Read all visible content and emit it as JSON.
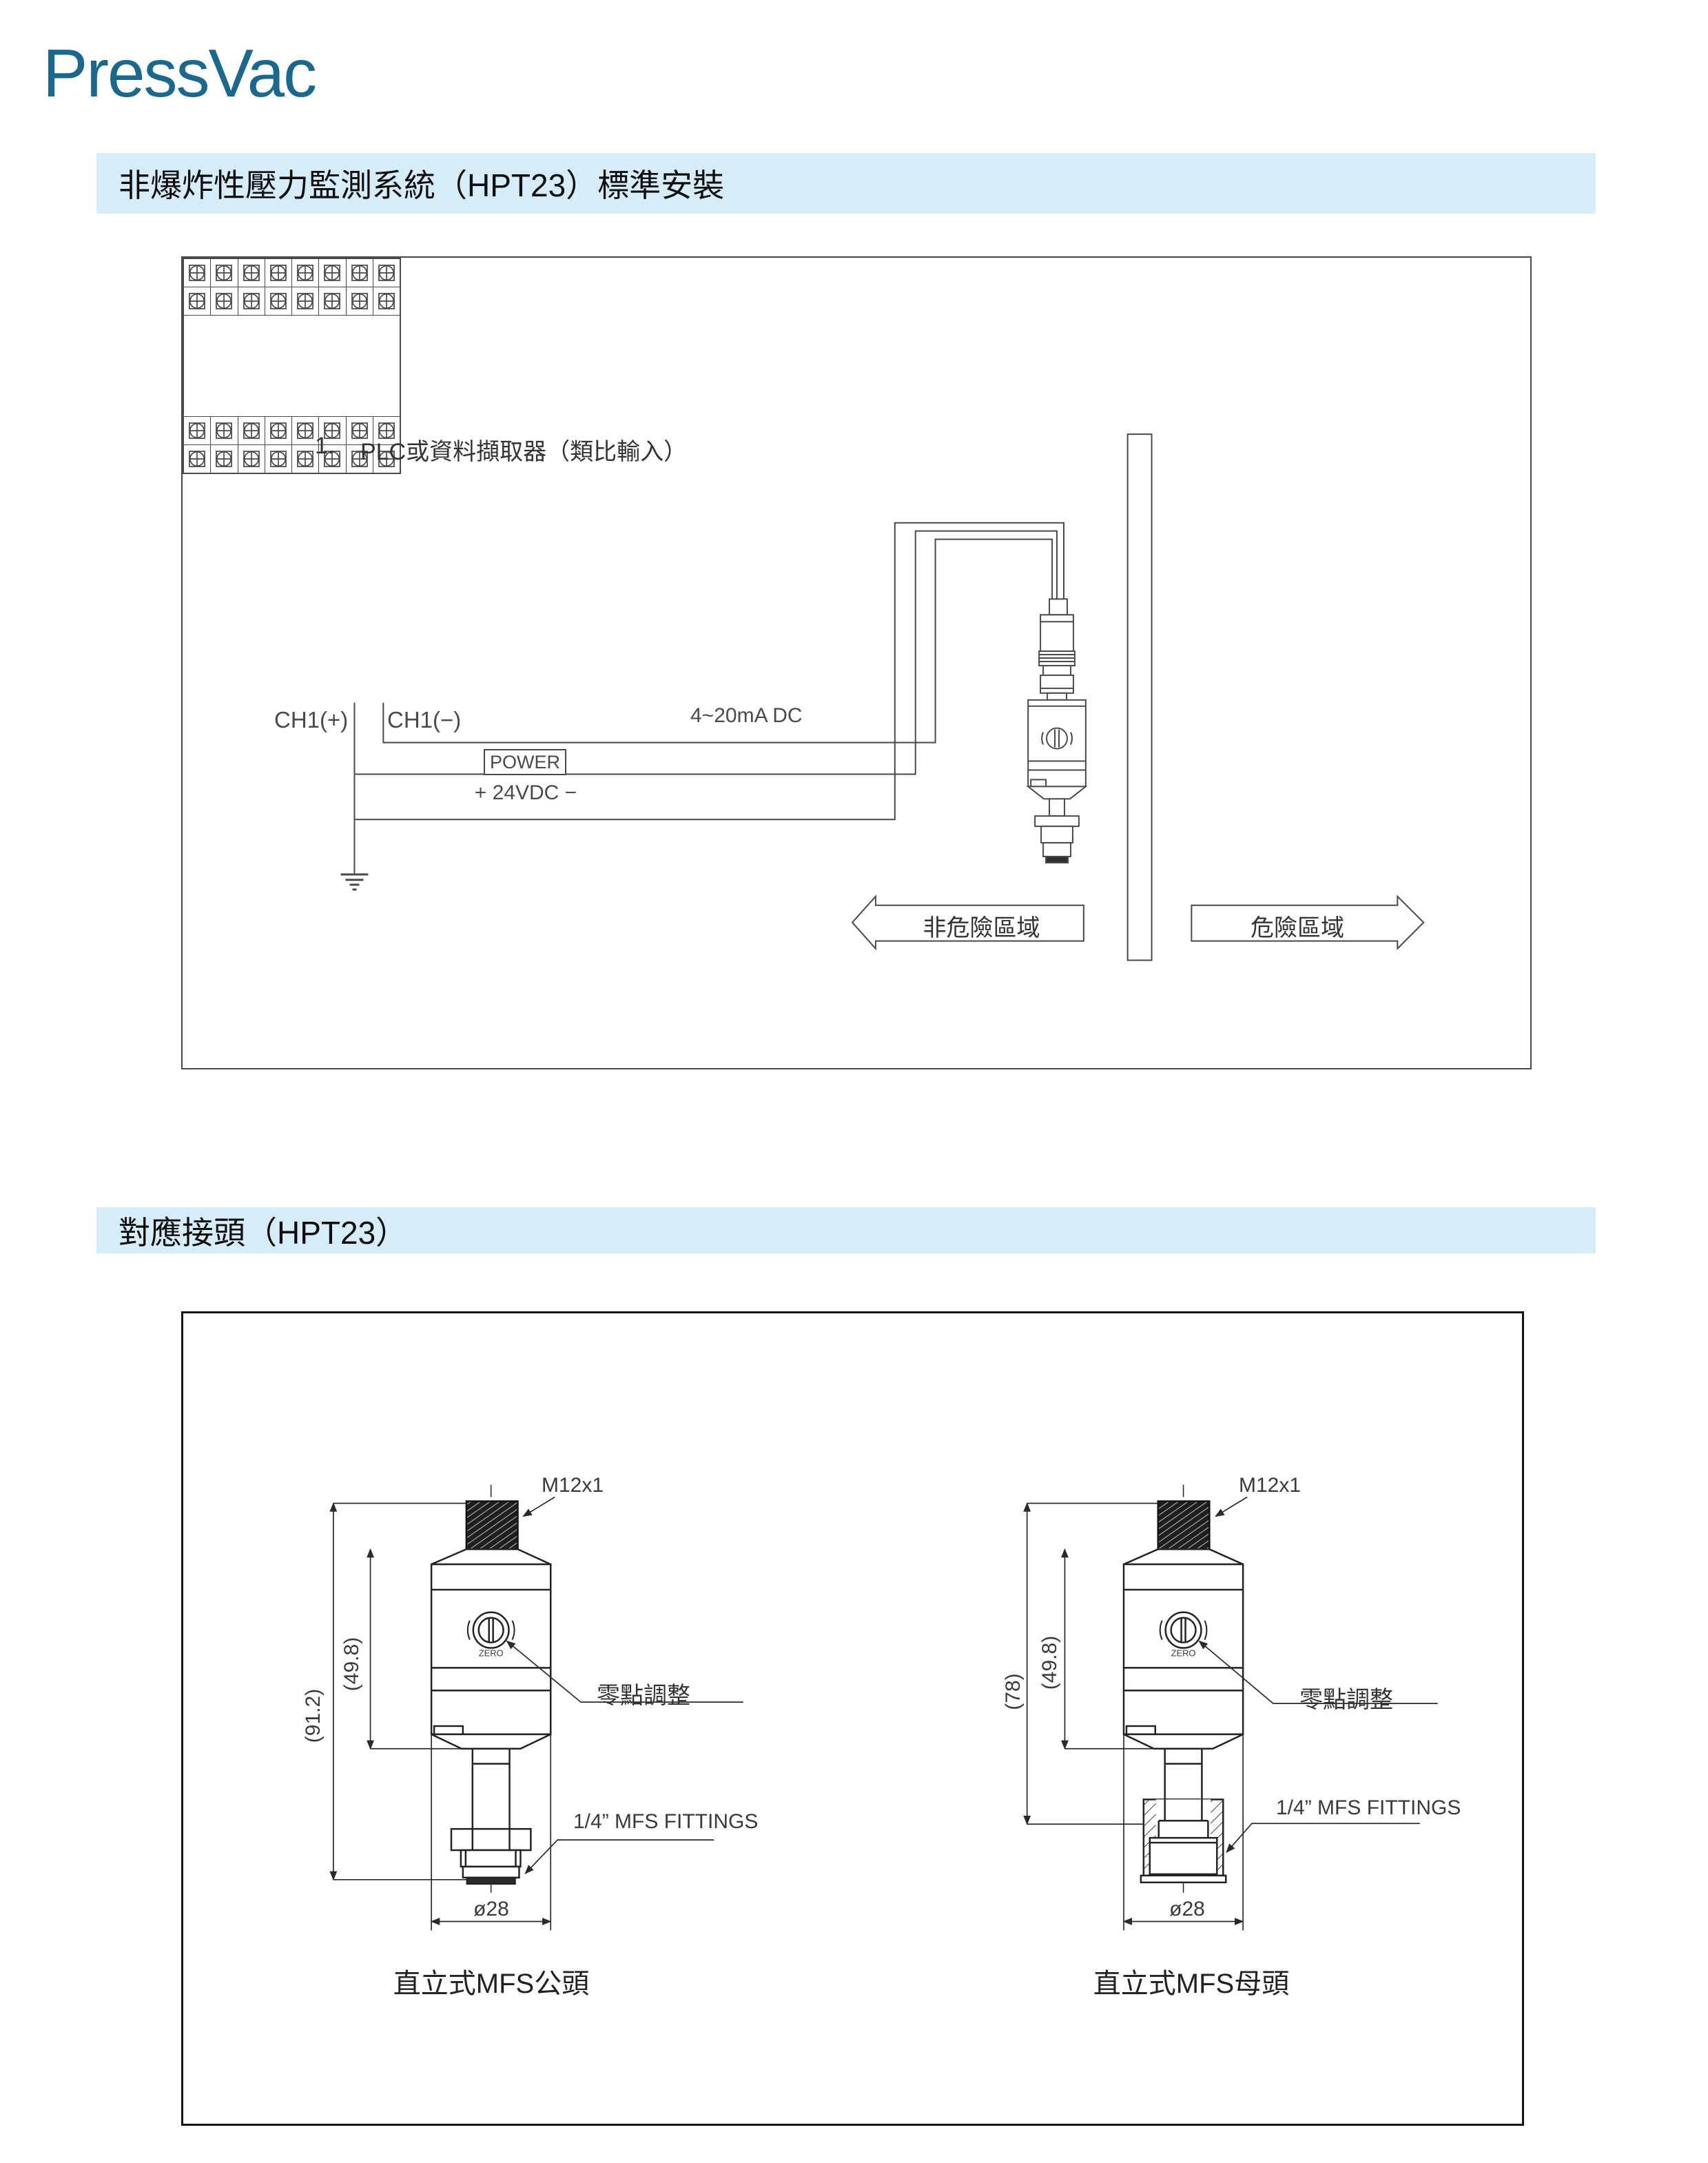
{
  "page": {
    "logo": "PressVac"
  },
  "colors": {
    "accent_band": "#d5edf8",
    "logo": "#19688e",
    "line": "#4a4a4a"
  },
  "section1": {
    "header": "非爆炸性壓力監測系統（HPT23）標準安裝",
    "figure": {
      "plc_item_number": "1.",
      "plc_label": "PLC或資料擷取器（類比輸入）",
      "ch1_plus": "CH1(+)",
      "ch1_minus": "CH1(−)",
      "signal_label": "4~20mA DC",
      "power_label": "POWER",
      "power_voltage": "+ 24VDC −",
      "zone_left": "非危險區域",
      "zone_right": "危險區域",
      "terminal_block": {
        "cols": 8,
        "top_rows": 2,
        "bottom_rows": 2
      }
    }
  },
  "section2": {
    "header": "對應接頭（HPT23）",
    "left_unit": {
      "thread_label": "M12x1",
      "zero_adjust_label": "零點調整",
      "zero_text": "ZERO",
      "fitting_label": "1/4” MFS FITTINGS",
      "dim_overall": "(91.2)",
      "dim_body": "(49.8)",
      "dim_diameter": "ø28",
      "caption": "直立式MFS公頭"
    },
    "right_unit": {
      "thread_label": "M12x1",
      "zero_adjust_label": "零點調整",
      "zero_text": "ZERO",
      "fitting_label": "1/4” MFS FITTINGS",
      "dim_overall": "(78)",
      "dim_body": "(49.8)",
      "dim_diameter": "ø28",
      "caption": "直立式MFS母頭"
    }
  }
}
